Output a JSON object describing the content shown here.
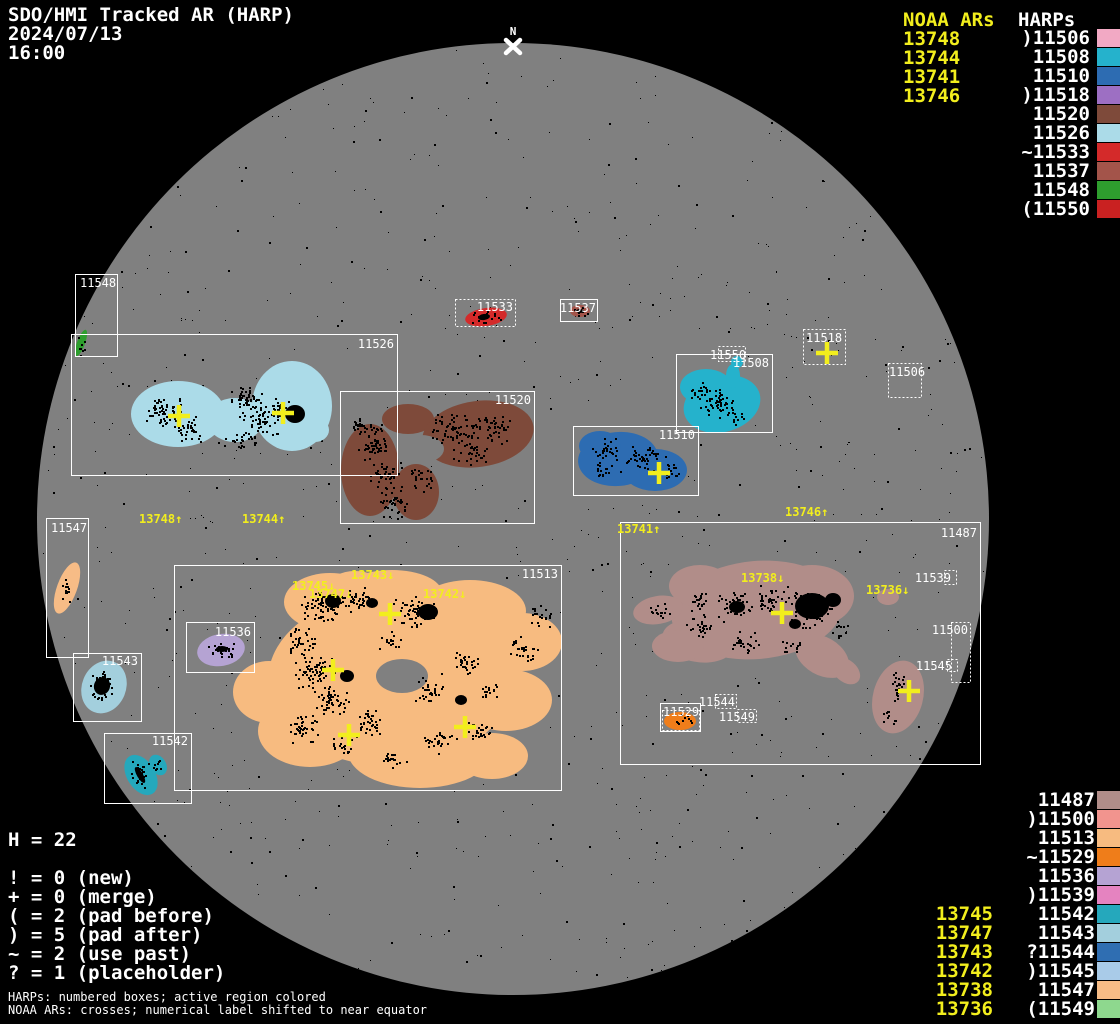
{
  "header": {
    "title": "SDO/HMI Tracked AR (HARP)",
    "date": "2024/07/13",
    "time": "16:00"
  },
  "north_marker": {
    "label": "N"
  },
  "colors": {
    "background": "#000000",
    "disk": "#808080",
    "box_stroke": "#ffffff",
    "noaa_yellow": "#f2ee1d",
    "speckle": "#000000"
  },
  "legend_top": {
    "noaa_title": "NOAA ARs",
    "harp_title": "HARPs",
    "noaa_items": [
      "13748",
      "13744",
      "13741",
      "13746"
    ],
    "harp_items": [
      {
        "prefix": ")",
        "id": "11506",
        "color": "#f2a9c4"
      },
      {
        "prefix": "",
        "id": "11508",
        "color": "#25b2cc"
      },
      {
        "prefix": "",
        "id": "11510",
        "color": "#2d6cb2"
      },
      {
        "prefix": ")",
        "id": "11518",
        "color": "#9d6fc3"
      },
      {
        "prefix": "",
        "id": "11520",
        "color": "#7e4a3a"
      },
      {
        "prefix": "",
        "id": "11526",
        "color": "#abdbe8"
      },
      {
        "prefix": "~",
        "id": "11533",
        "color": "#d42a2a"
      },
      {
        "prefix": "",
        "id": "11537",
        "color": "#a3544a"
      },
      {
        "prefix": "",
        "id": "11548",
        "color": "#2e9e2e"
      },
      {
        "prefix": "(",
        "id": "11550",
        "color": "#c92121"
      }
    ]
  },
  "legend_bottom": {
    "noaa_items": [
      "13745",
      "13747",
      "13743",
      "13742",
      "13738",
      "13736"
    ],
    "harp_items": [
      {
        "prefix": "",
        "id": "11487",
        "color": "#b18d89"
      },
      {
        "prefix": ")",
        "id": "11500",
        "color": "#f2948e"
      },
      {
        "prefix": "",
        "id": "11513",
        "color": "#f7bb80"
      },
      {
        "prefix": "~",
        "id": "11529",
        "color": "#ef7d1a"
      },
      {
        "prefix": "",
        "id": "11536",
        "color": "#b5a3d3"
      },
      {
        "prefix": ")",
        "id": "11539",
        "color": "#e583c0"
      },
      {
        "prefix": "",
        "id": "11542",
        "color": "#25a8bc"
      },
      {
        "prefix": "",
        "id": "11543",
        "color": "#a3cfdd"
      },
      {
        "prefix": "?",
        "id": "11544",
        "color": "#2f6eb2"
      },
      {
        "prefix": ")",
        "id": "11545",
        "color": "#a9cbe8"
      },
      {
        "prefix": "",
        "id": "11547",
        "color": "#f7bc86"
      },
      {
        "prefix": "(",
        "id": "11549",
        "color": "#8ed88e"
      }
    ]
  },
  "stats": {
    "h_line": "H = 22",
    "lines": [
      "! = 0 (new)",
      "+ = 0 (merge)",
      "( = 2 (pad before)",
      ") = 5 (pad after)",
      "~ = 2 (use past)",
      "? = 1 (placeholder)"
    ]
  },
  "footnotes": [
    "HARPs: numbered boxes; active region colored",
    "NOAA ARs: crosses; numerical label shifted to near equator"
  ],
  "disk": {
    "cx": 513,
    "cy": 519,
    "r": 476,
    "boxes": [
      {
        "id": "11548",
        "x": 75,
        "y": 274,
        "w": 42,
        "h": 82,
        "style": "solid",
        "lx": 80,
        "ly": 287,
        "la": "s"
      },
      {
        "id": "11526",
        "x": 71,
        "y": 334,
        "w": 326,
        "h": 141,
        "style": "solid",
        "lx": 394,
        "ly": 348,
        "la": "e"
      },
      {
        "id": "11520",
        "x": 340,
        "y": 391,
        "w": 194,
        "h": 132,
        "style": "solid",
        "lx": 531,
        "ly": 404,
        "la": "e"
      },
      {
        "id": "11533",
        "x": 455,
        "y": 299,
        "w": 60,
        "h": 27,
        "style": "dotted",
        "lx": 513,
        "ly": 311,
        "la": "e"
      },
      {
        "id": "11537",
        "x": 560,
        "y": 299,
        "w": 37,
        "h": 22,
        "style": "solid",
        "lx": 596,
        "ly": 312,
        "la": "e"
      },
      {
        "id": "11518",
        "x": 803,
        "y": 329,
        "w": 42,
        "h": 35,
        "style": "dotted",
        "lx": 806,
        "ly": 342,
        "la": "s"
      },
      {
        "id": "11506",
        "x": 888,
        "y": 363,
        "w": 33,
        "h": 34,
        "style": "dotted",
        "lx": 889,
        "ly": 376,
        "la": "s"
      },
      {
        "id": "11550",
        "x": 718,
        "y": 346,
        "w": 27,
        "h": 15,
        "style": "dotted",
        "lx": 710,
        "ly": 359,
        "la": "s"
      },
      {
        "id": "11508",
        "x": 676,
        "y": 354,
        "w": 96,
        "h": 78,
        "style": "solid",
        "lx": 769,
        "ly": 367,
        "la": "e"
      },
      {
        "id": "11510",
        "x": 573,
        "y": 426,
        "w": 125,
        "h": 69,
        "style": "solid",
        "lx": 695,
        "ly": 439,
        "la": "e"
      },
      {
        "id": "11547",
        "x": 46,
        "y": 518,
        "w": 42,
        "h": 139,
        "style": "solid",
        "lx": 51,
        "ly": 532,
        "la": "s"
      },
      {
        "id": "11513",
        "x": 174,
        "y": 565,
        "w": 387,
        "h": 225,
        "style": "solid",
        "lx": 558,
        "ly": 578,
        "la": "e"
      },
      {
        "id": "11536",
        "x": 186,
        "y": 622,
        "w": 68,
        "h": 50,
        "style": "solid",
        "lx": 251,
        "ly": 636,
        "la": "e"
      },
      {
        "id": "11543",
        "x": 73,
        "y": 653,
        "w": 68,
        "h": 68,
        "style": "solid",
        "lx": 138,
        "ly": 665,
        "la": "e"
      },
      {
        "id": "11542",
        "x": 104,
        "y": 733,
        "w": 87,
        "h": 70,
        "style": "solid",
        "lx": 188,
        "ly": 745,
        "la": "e"
      },
      {
        "id": "11487",
        "x": 620,
        "y": 522,
        "w": 360,
        "h": 242,
        "style": "solid",
        "lx": 977,
        "ly": 537,
        "la": "e"
      },
      {
        "id": "11529",
        "x": 660,
        "y": 703,
        "w": 40,
        "h": 28,
        "style": "solid",
        "lx": 663,
        "ly": 716,
        "la": "s",
        "ix": 662,
        "iy": 710,
        "iw": 37,
        "ih": 20
      },
      {
        "id": "11544",
        "x": 715,
        "y": 694,
        "w": 21,
        "h": 14,
        "style": "dotted",
        "lx": 735,
        "ly": 706,
        "la": "e"
      },
      {
        "id": "11549",
        "x": 737,
        "y": 709,
        "w": 19,
        "h": 13,
        "style": "dotted",
        "lx": 755,
        "ly": 721,
        "la": "e"
      },
      {
        "id": "11539",
        "x": 944,
        "y": 570,
        "w": 12,
        "h": 14,
        "style": "dotted",
        "lx": 951,
        "ly": 582,
        "la": "e"
      },
      {
        "id": "11500",
        "x": 951,
        "y": 622,
        "w": 19,
        "h": 60,
        "style": "dotted",
        "lx": 968,
        "ly": 634,
        "la": "e"
      },
      {
        "id": "11545",
        "x": 947,
        "y": 659,
        "w": 10,
        "h": 12,
        "style": "dotted",
        "lx": 952,
        "ly": 670,
        "la": "e"
      }
    ],
    "regions": [
      {
        "harp": "11548",
        "shapes": [
          [
            81,
            343,
            4,
            14,
            20
          ]
        ]
      },
      {
        "harp": "11547",
        "shapes": [
          [
            67,
            588,
            10,
            27,
            20
          ]
        ]
      },
      {
        "harp": "11526",
        "shapes": [
          [
            178,
            414,
            47,
            33,
            0
          ],
          [
            235,
            420,
            28,
            22,
            0
          ],
          [
            292,
            406,
            40,
            45,
            0
          ],
          [
            315,
            430,
            14,
            12,
            0
          ]
        ]
      },
      {
        "harp": "11520",
        "shapes": [
          [
            370,
            470,
            29,
            46,
            0
          ],
          [
            408,
            419,
            26,
            15,
            0
          ],
          [
            478,
            434,
            56,
            33,
            -8
          ],
          [
            416,
            492,
            23,
            28,
            0
          ]
        ]
      },
      {
        "hole": true,
        "shapes": [
          [
            421,
            449,
            23,
            14,
            0
          ]
        ]
      },
      {
        "harp": "11508",
        "shapes": [
          [
            722,
            404,
            39,
            28,
            -15
          ],
          [
            706,
            387,
            26,
            18,
            0
          ],
          [
            737,
            362,
            6,
            6,
            0
          ],
          [
            733,
            376,
            7,
            12,
            0
          ]
        ]
      },
      {
        "harp": "11510",
        "shapes": [
          [
            618,
            459,
            40,
            27,
            -5
          ],
          [
            655,
            470,
            32,
            21,
            0
          ],
          [
            600,
            446,
            21,
            15,
            0
          ]
        ]
      },
      {
        "harp": "11533",
        "shapes": [
          [
            486,
            317,
            21,
            9,
            -8
          ]
        ]
      },
      {
        "harp": "11537",
        "shapes": [
          [
            580,
            311,
            10,
            6,
            0
          ]
        ]
      },
      {
        "harp": "11536",
        "shapes": [
          [
            221,
            650,
            24,
            16,
            -10
          ]
        ]
      },
      {
        "harp": "11543",
        "shapes": [
          [
            104,
            687,
            22,
            27,
            22
          ]
        ]
      },
      {
        "harp": "11542",
        "shapes": [
          [
            141,
            775,
            14,
            22,
            -32
          ],
          [
            158,
            765,
            8,
            11,
            -32
          ]
        ]
      },
      {
        "harp": "11529",
        "shapes": [
          [
            680,
            721,
            16,
            9,
            0
          ]
        ]
      },
      {
        "harp": "11513",
        "shapes": [
          [
            390,
            680,
            122,
            86,
            0
          ],
          [
            330,
            602,
            46,
            29,
            0
          ],
          [
            392,
            593,
            50,
            23,
            0
          ],
          [
            470,
            611,
            56,
            31,
            0
          ],
          [
            522,
            642,
            40,
            29,
            0
          ],
          [
            506,
            700,
            46,
            31,
            0
          ],
          [
            420,
            752,
            72,
            36,
            0
          ],
          [
            310,
            731,
            52,
            36,
            0
          ],
          [
            269,
            692,
            36,
            31,
            0
          ],
          [
            492,
            756,
            36,
            23,
            0
          ],
          [
            355,
            586,
            26,
            15,
            0
          ]
        ]
      },
      {
        "hole": true,
        "shapes": [
          [
            402,
            676,
            26,
            17,
            0
          ]
        ]
      },
      {
        "harp": "11487",
        "shapes": [
          [
            757,
            610,
            86,
            49,
            -5
          ],
          [
            700,
            586,
            31,
            21,
            0
          ],
          [
            812,
            596,
            42,
            31,
            0
          ],
          [
            698,
            641,
            36,
            21,
            10
          ],
          [
            678,
            646,
            26,
            16,
            0
          ],
          [
            822,
            656,
            29,
            19,
            30
          ],
          [
            846,
            671,
            16,
            11,
            40
          ],
          [
            658,
            610,
            25,
            14,
            -10
          ],
          [
            888,
            597,
            11,
            8,
            0
          ],
          [
            898,
            697,
            25,
            37,
            15
          ]
        ]
      }
    ],
    "crosses": [
      {
        "x": 179,
        "y": 416
      },
      {
        "x": 283,
        "y": 413
      },
      {
        "x": 659,
        "y": 473
      },
      {
        "x": 827,
        "y": 353
      },
      {
        "x": 390,
        "y": 614
      },
      {
        "x": 333,
        "y": 670
      },
      {
        "x": 349,
        "y": 735
      },
      {
        "x": 465,
        "y": 727
      },
      {
        "x": 782,
        "y": 613
      },
      {
        "x": 909,
        "y": 691
      }
    ],
    "ar_labels": [
      {
        "text": "13748↑",
        "x": 139,
        "y": 523
      },
      {
        "text": "13744↑",
        "x": 242,
        "y": 523
      },
      {
        "text": "13741↑",
        "x": 617,
        "y": 533
      },
      {
        "text": "13746↑",
        "x": 785,
        "y": 516
      },
      {
        "text": "13745↓",
        "x": 292,
        "y": 590
      },
      {
        "text": "13747↓",
        "x": 309,
        "y": 598
      },
      {
        "text": "13743↓",
        "x": 351,
        "y": 579
      },
      {
        "text": "13742↓",
        "x": 423,
        "y": 598
      },
      {
        "text": "13738↓",
        "x": 741,
        "y": 582
      },
      {
        "text": "13736↓",
        "x": 866,
        "y": 594
      }
    ]
  }
}
